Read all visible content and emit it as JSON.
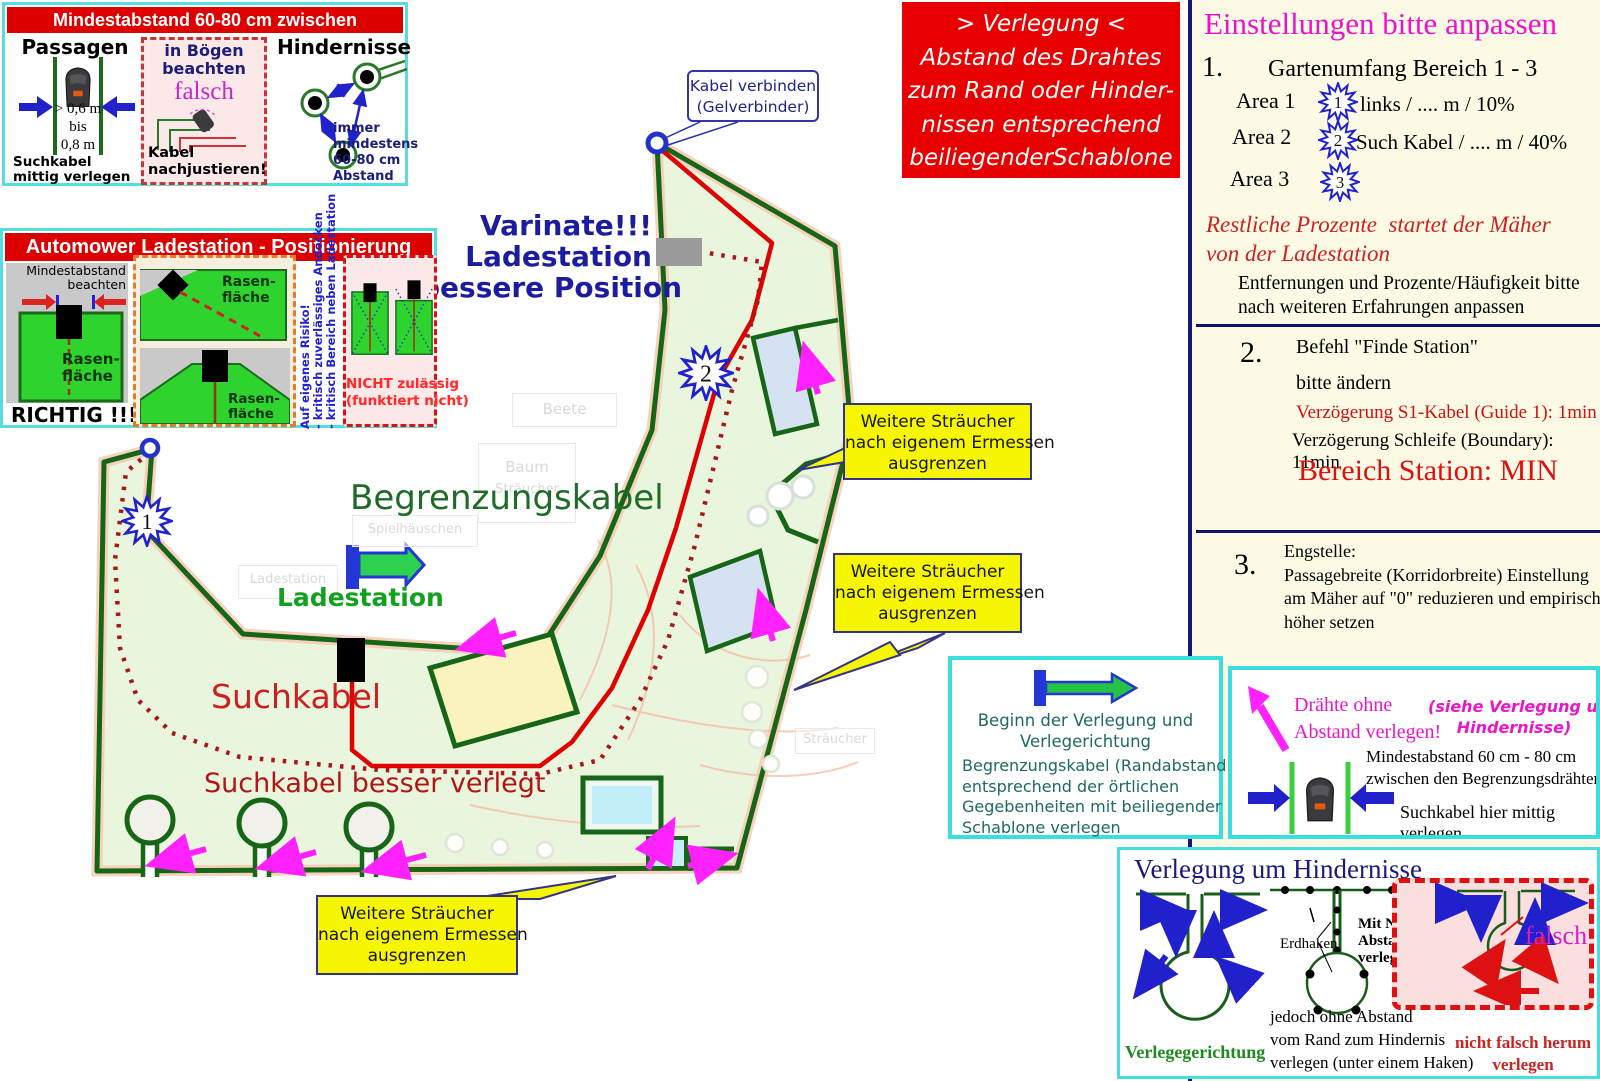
{
  "boxA": {
    "title": "Mindestabstand 60-80 cm zwischen Begrenzungsdrähten",
    "passagen": {
      "heading": "Passagen",
      "d1": "> 0,6 m",
      "d2": "bis",
      "d3": "0,8 m",
      "note": "Suchkabel\nmittig verlegen"
    },
    "boegen": {
      "heading": "in Bögen\nbeachten",
      "falsch": "falsch",
      "note": "Kabel\nnachjustieren!"
    },
    "hindernisse": {
      "heading": "Hindernisse",
      "note": "immer\nmindestens\n60-80 cm\nAbstand"
    }
  },
  "boxB": {
    "title": "Automower Ladestation - Positionierung",
    "left_note": "Mindestabstand\nbeachten",
    "rasen": "Rasen-\nfläche",
    "richtig": "RICHTIG !!!",
    "risk_vertical": "Auf eigenes Risiko!\n- kritisch zuverlässiges Andocken\n- kritisch Bereich neben Ladestation",
    "nicht": "NICHT zulässig\n(funktiert nicht)"
  },
  "red_note": {
    "text": "> Verlegung <\nAbstand des Drahtes\nzum Rand oder Hinder-\nnissen entsprechend\nbeiliegenderSchablone"
  },
  "panel": {
    "title": "Einstellungen bitte anpassen",
    "n1": "1.",
    "item1": "Gartenumfang Bereich 1 - 3",
    "area1": "Area 1",
    "star1": "1",
    "val1": "links / .... m / 10%",
    "area2": "Area 2",
    "star2": "2",
    "val2": "Such Kabel / .... m / 40%",
    "area3": "Area 3",
    "star3": "3",
    "restliche": "Restliche Prozente  startet der Mäher\nvon der Ladestation",
    "entfernungen": "Entfernungen und Prozente/Häufigkeit bitte\nnach weiteren Erfahrungen anpassen",
    "n2": "2.",
    "befehl": "Befehl \"Finde Station\"",
    "bitte": "bitte ändern",
    "verz1": "Verzögerung S1-Kabel (Guide 1): 1min",
    "verz2": "Verzögerung Schleife (Boundary): 11min",
    "bereich": "Bereich Station: MIN",
    "n3": "3.",
    "item3": "Engstelle:\nPassagebreite (Korridorbreite) Einstellung\nam Mäher auf \"0\" reduzieren und empirisch\nhöher setzen"
  },
  "map": {
    "kabel_callout": "Kabel verbinden\n(Gelverbinder)",
    "variante": "Varinate!!!\nLadestation\nbessere Position",
    "begrenzungskabel": "Begrenzungskabel",
    "ladestation": "Ladestation",
    "suchkabel": "Suchkabel",
    "suchkabel_besser": "Suchkabel besser verlegt",
    "callout_straeucher": "Weitere Sträucher\nnach eigenem Ermessen\nausgrenzen",
    "star1": "1",
    "star2": "2",
    "bg": {
      "beete": "Beete",
      "baum": "Baum",
      "baum2": "Sträucher",
      "spielhaus": "Spielhäuschen",
      "ladestation": "Ladestation",
      "straeucher": "Sträucher"
    }
  },
  "boxC": {
    "line1": "Beginn der Verlegung und\nVerlegerichtung",
    "line2": "Begrenzungskabel (Randabstand)\nentsprechend der örtlichen\nGegebenheiten mit beiliegender\nSchablone verlegen"
  },
  "boxD": {
    "magenta": "Drähte ohne\nAbstand verlegen!",
    "siehe": "(siehe Verlegung um\nHindernisse)",
    "min": "Mindestabstand 60 cm - 80 cm\nzwischen den Begrenzungsdrähten",
    "such": "Suchkabel hier mittig verlegen"
  },
  "boxE": {
    "title": "Verlegung um Hindernisse",
    "erdhaken": "Erdhaken",
    "mitnull": "Mit Null\nAbstand\nverlegen",
    "verlegerichtung": "Verlegegerichtung",
    "jedoch": "jedoch ohne Abstand\nvom Rand zum Hindernis\nverlegen (unter einem Haken)",
    "falsch": "falsch",
    "nicht": "nicht falsch herum\nverlegen"
  },
  "colors": {
    "accent_red": "#dd0000",
    "boundary_green": "#176617",
    "magenta": "#ee22cc",
    "callout_yellow": "#f6f600",
    "panel_bg": "#fcfae4"
  }
}
